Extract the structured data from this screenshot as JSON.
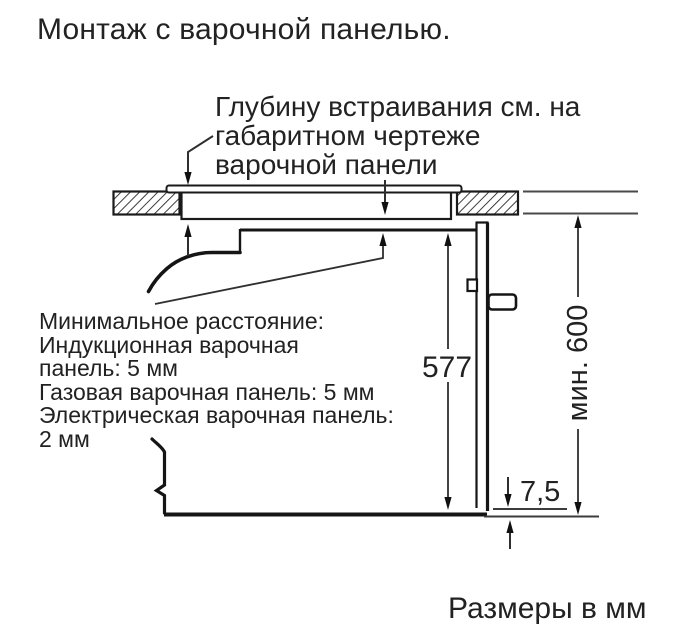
{
  "title": "Монтаж с варочной панелью.",
  "callout_hob_depth": {
    "lines": [
      "Глубину встраивания см. на",
      "габаритном чертеже",
      "варочной панели"
    ]
  },
  "min_distance_note": {
    "lines": [
      "Минимальное расстояние:",
      "Индукционная варочная",
      "панель: 5 мм",
      "Газовая варочная панель: 5 мм",
      "Электрическая варочная панель:",
      "2 мм"
    ]
  },
  "dimensions": {
    "oven_height": "577",
    "min_clearance": "мин. 600",
    "door_bottom_gap": "7,5"
  },
  "units_note": "Размеры в мм",
  "colors": {
    "background": "#ffffff",
    "ink": "#1a1a1a",
    "thin_line": "#3c3c3c"
  }
}
